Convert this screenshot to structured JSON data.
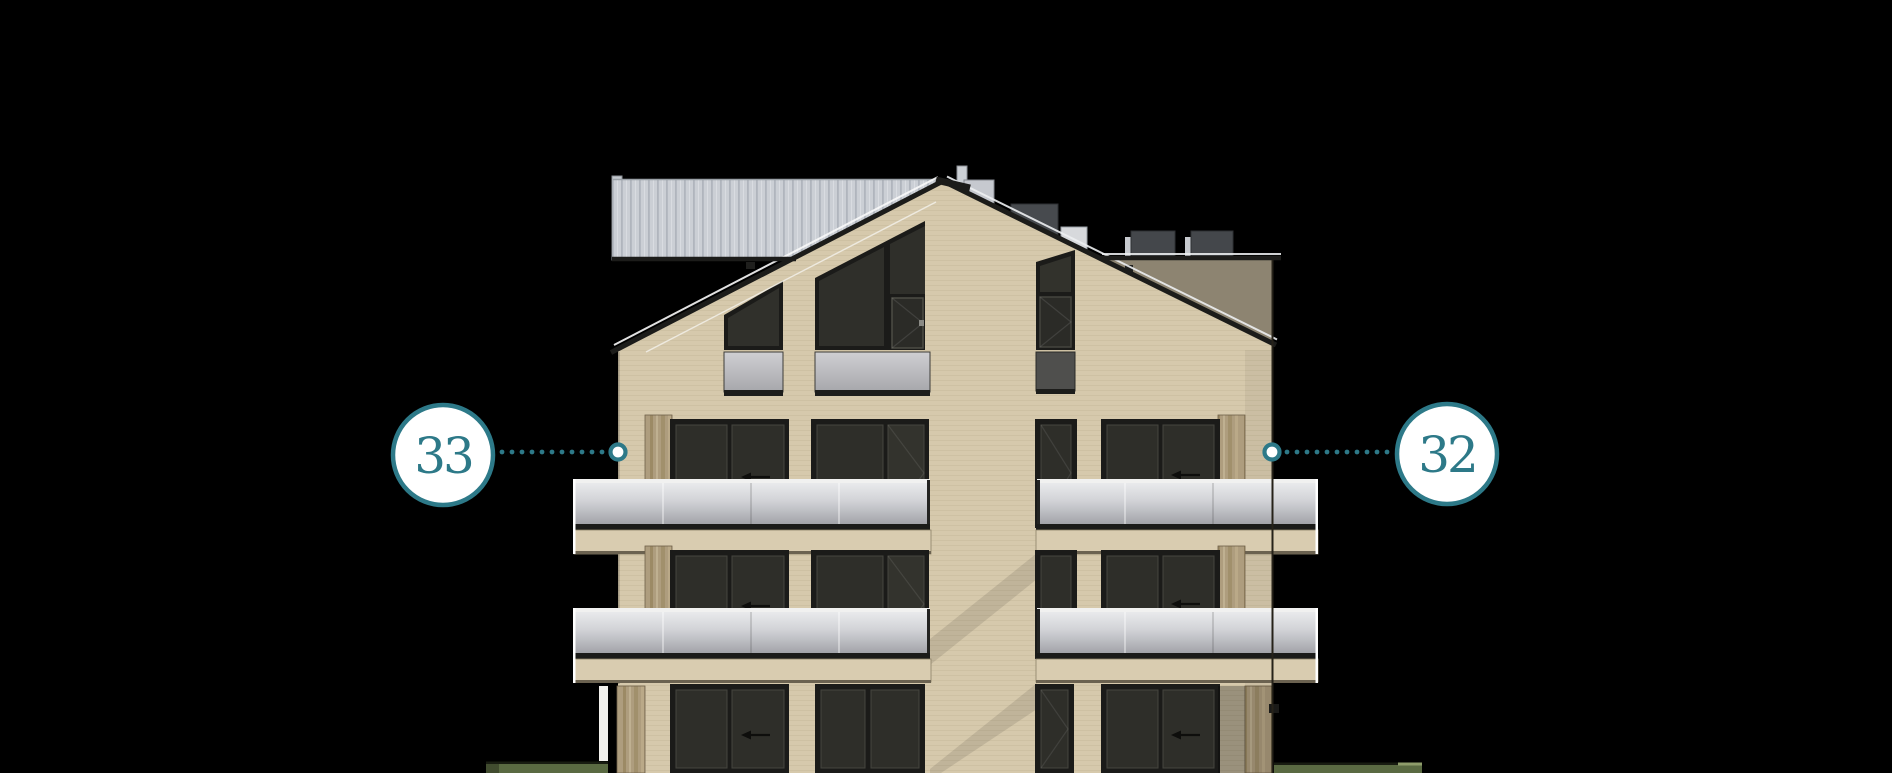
{
  "page": {
    "background": "#000000",
    "description": "apartment building front elevation with unit callouts"
  },
  "annotations": {
    "unit_left": {
      "label": "33"
    },
    "unit_right": {
      "label": "32"
    }
  },
  "icons": {
    "leader_left": "dotted-leader-line",
    "leader_right": "dotted-leader-line",
    "marker_left": "point-marker-circle",
    "marker_right": "point-marker-circle"
  },
  "colors": {
    "accent_teal": "#2d7988",
    "badge_fill": "#ffffff",
    "facade_beige": "#d6c9ac",
    "roof_dark": "#1c1c1a",
    "window_dark": "#2e2e29",
    "railing_glass": "#c8c9cd",
    "corrugated_gray": "#cbcfd5",
    "wood_tan": "#ae9d7e",
    "roof_shadow_taupe": "#8d8471",
    "grass_green": "#5a6a42"
  }
}
